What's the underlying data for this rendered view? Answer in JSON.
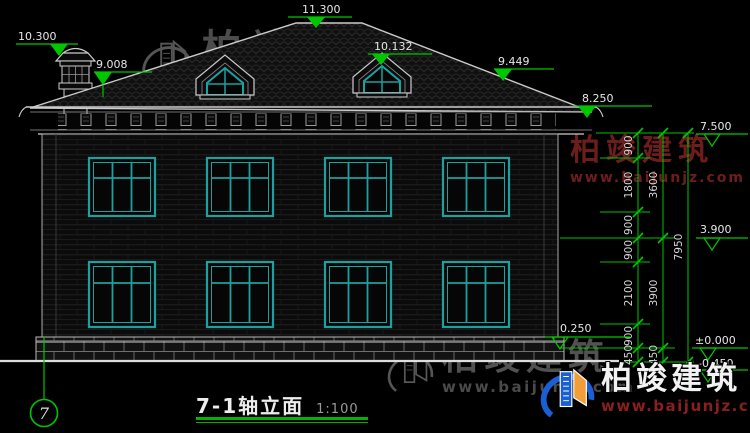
{
  "title": {
    "text": "7-1轴立面",
    "scale": "1:100"
  },
  "axis": {
    "label": "7"
  },
  "levels": {
    "chimney_top": "10.300",
    "roof_left": "9.008",
    "ridge": "11.300",
    "dormer_top": "10.132",
    "roof_right": "9.449",
    "eave": "8.250",
    "top": "7.500",
    "floor2": "3.900",
    "plinth": "0.250",
    "zero": "±0.000",
    "ground": "-0.450"
  },
  "dims": {
    "inner": [
      "900",
      "1800",
      "900",
      "900",
      "2100",
      "900",
      "450"
    ],
    "mid": [
      "3600",
      "3900",
      "450"
    ],
    "total": "7950"
  },
  "watermark": {
    "brand": "柏竣建筑",
    "url": "www.baijunjz.com"
  },
  "colors": {
    "dimension_green": "#00c600",
    "window_teal": "#1ca0a0",
    "line_white": "#d8d8d8",
    "watermark_red": "#6e1d1d",
    "logo_blue": "#1a5fd4",
    "logo_orange": "#f29e38"
  }
}
